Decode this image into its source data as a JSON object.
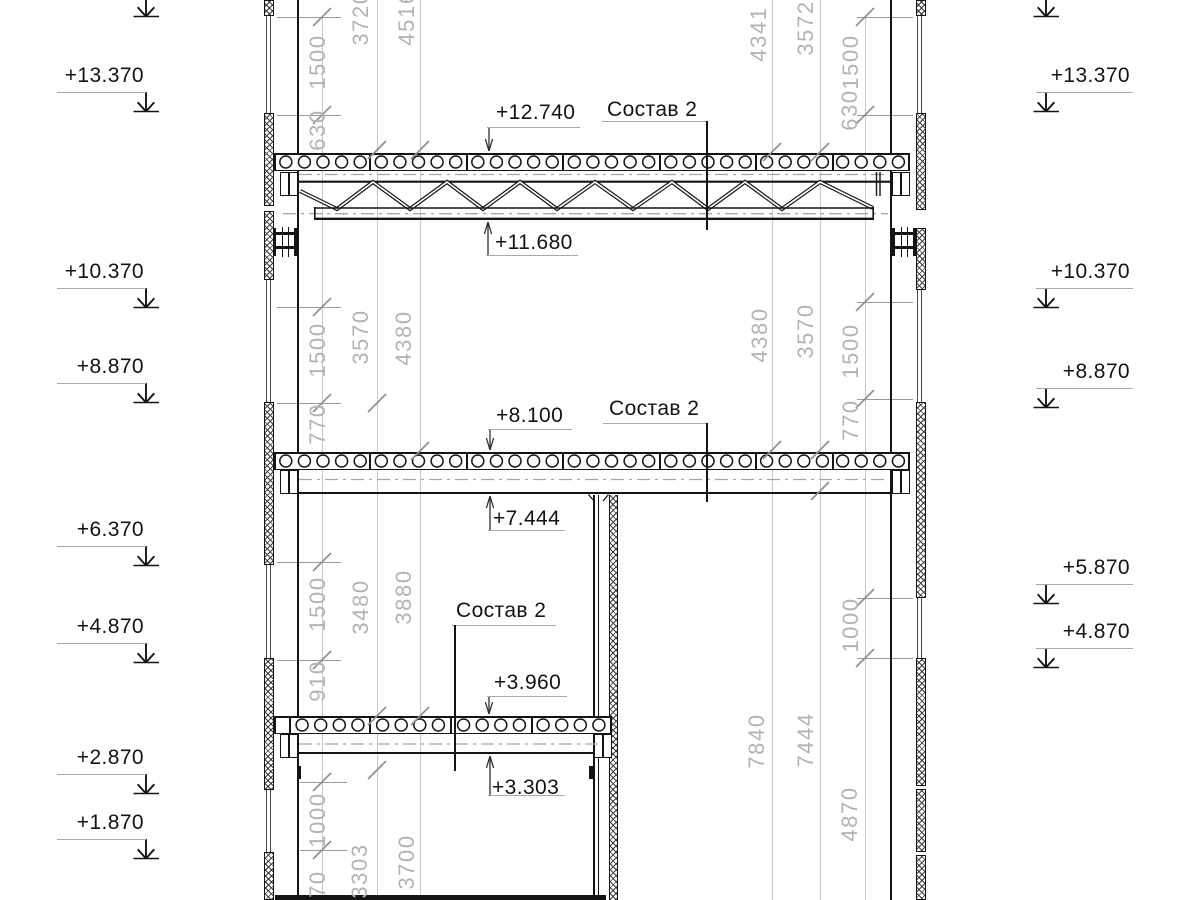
{
  "drawing_type": "building section",
  "colors": {
    "line": "#141414",
    "dim_text": "#b3b3b3",
    "dim_line": "#c7c7c7",
    "tick": "#8f8f8f",
    "underline": "#a8a8a8"
  },
  "elevation_marks_left": [
    {
      "label": "+13.370",
      "y": 65
    },
    {
      "label": "+10.370",
      "y": 261
    },
    {
      "label": "+8.870",
      "y": 356
    },
    {
      "label": "+6.370",
      "y": 519
    },
    {
      "label": "+4.870",
      "y": 616
    },
    {
      "label": "+2.870",
      "y": 747
    },
    {
      "label": "+1.870",
      "y": 812
    }
  ],
  "elevation_marks_right": [
    {
      "label": "+13.370",
      "y": 65
    },
    {
      "label": "+10.370",
      "y": 261
    },
    {
      "label": "+8.870",
      "y": 361
    },
    {
      "label": "+5.870",
      "y": 557
    },
    {
      "label": "+4.870",
      "y": 621
    }
  ],
  "level_labels": [
    {
      "label": "+12.740",
      "x": 496,
      "y": 100,
      "direction": "down"
    },
    {
      "label": "+11.680",
      "x": 495,
      "y": 230,
      "direction": "up"
    },
    {
      "label": "+8.100",
      "x": 496,
      "y": 403,
      "direction": "down"
    },
    {
      "label": "+7.444",
      "x": 493,
      "y": 506,
      "direction": "up"
    },
    {
      "label": "+3.960",
      "x": 494,
      "y": 670,
      "direction": "down"
    },
    {
      "label": "+3.303",
      "x": 492,
      "y": 775,
      "direction": "up"
    }
  ],
  "composition_labels": [
    {
      "label": "Состав 2",
      "x": 607,
      "y": 97
    },
    {
      "label": "Состав 2",
      "x": 609,
      "y": 396
    },
    {
      "label": "Состав 2",
      "x": 456,
      "y": 598
    }
  ],
  "dimension_texts": [
    {
      "value": "1500",
      "x": 318,
      "y": 62
    },
    {
      "value": "630",
      "x": 318,
      "y": 130
    },
    {
      "value": "3720",
      "x": 361,
      "y": 18
    },
    {
      "value": "4516",
      "x": 407,
      "y": 18
    },
    {
      "value": "4341",
      "x": 759,
      "y": 34
    },
    {
      "value": "3572",
      "x": 806,
      "y": 28
    },
    {
      "value": "1500",
      "x": 851,
      "y": 62
    },
    {
      "value": "630",
      "x": 850,
      "y": 110
    },
    {
      "value": "1500",
      "x": 318,
      "y": 350
    },
    {
      "value": "770",
      "x": 318,
      "y": 424
    },
    {
      "value": "3570",
      "x": 361,
      "y": 337
    },
    {
      "value": "4380",
      "x": 404,
      "y": 338
    },
    {
      "value": "4380",
      "x": 760,
      "y": 335
    },
    {
      "value": "3570",
      "x": 806,
      "y": 331
    },
    {
      "value": "1500",
      "x": 851,
      "y": 351
    },
    {
      "value": "770",
      "x": 851,
      "y": 420
    },
    {
      "value": "1500",
      "x": 318,
      "y": 604
    },
    {
      "value": "910",
      "x": 318,
      "y": 681
    },
    {
      "value": "3480",
      "x": 361,
      "y": 607
    },
    {
      "value": "3880",
      "x": 404,
      "y": 597
    },
    {
      "value": "1000",
      "x": 851,
      "y": 625
    },
    {
      "value": "4870",
      "x": 850,
      "y": 814
    },
    {
      "value": "7840",
      "x": 757,
      "y": 741
    },
    {
      "value": "7444",
      "x": 806,
      "y": 740
    },
    {
      "value": "1000",
      "x": 318,
      "y": 820
    },
    {
      "value": "970",
      "x": 318,
      "y": 891
    },
    {
      "value": "3303",
      "x": 360,
      "y": 871
    },
    {
      "value": "3700",
      "x": 407,
      "y": 862
    }
  ]
}
